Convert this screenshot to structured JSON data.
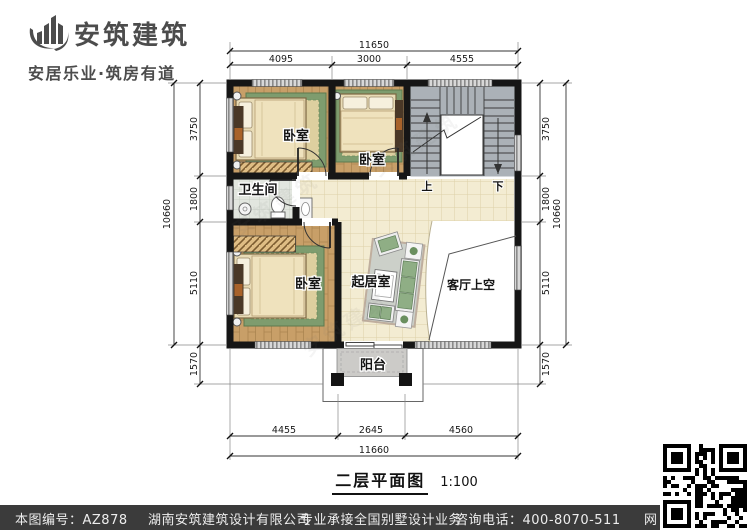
{
  "brand": {
    "name": "安筑建筑",
    "tagline": "安居乐业·筑房有道",
    "color": "#4c4c4c"
  },
  "drawing": {
    "title": "二层平面图",
    "scale": "1:100"
  },
  "plan": {
    "rooms": {
      "bedroom_top_left": "卧室",
      "bedroom_top_mid": "卧室",
      "bedroom_bottom_left": "卧室",
      "bathroom": "卫生间",
      "living_room": "起居室",
      "living_void": "客厅上空",
      "balcony": "阳台"
    },
    "stairs": {
      "up": "上",
      "down": "下"
    },
    "dims": {
      "top": {
        "total": "11650",
        "seg1": "4095",
        "seg2": "3000",
        "seg3": "4555"
      },
      "bottom": {
        "total": "11660",
        "seg1": "4455",
        "seg2": "2645",
        "seg3": "4560"
      },
      "left": {
        "total": "10660",
        "seg1": "3750",
        "seg2": "1800",
        "seg3": "5110",
        "seg4": "1570"
      },
      "right": {
        "total": "10660",
        "seg1": "3750",
        "seg2": "1800",
        "seg3": "5110",
        "seg4": "1570"
      }
    },
    "colors": {
      "wall": "#161616",
      "wood_floor": "#c89f68",
      "tile_floor": "#f3ecd2",
      "stairs": "#abb1b7",
      "rug_green": "#7e9c6e",
      "balcony": "#cccbc8",
      "footer_bar": "#3b3b3b"
    }
  },
  "footer": {
    "drawing_no": "本图编号：AZ878",
    "company": "湖南安筑建筑设计有限公司",
    "service": "专业承接全国别墅设计业务",
    "phone": "咨询电话：400-8070-511",
    "web": "网"
  }
}
